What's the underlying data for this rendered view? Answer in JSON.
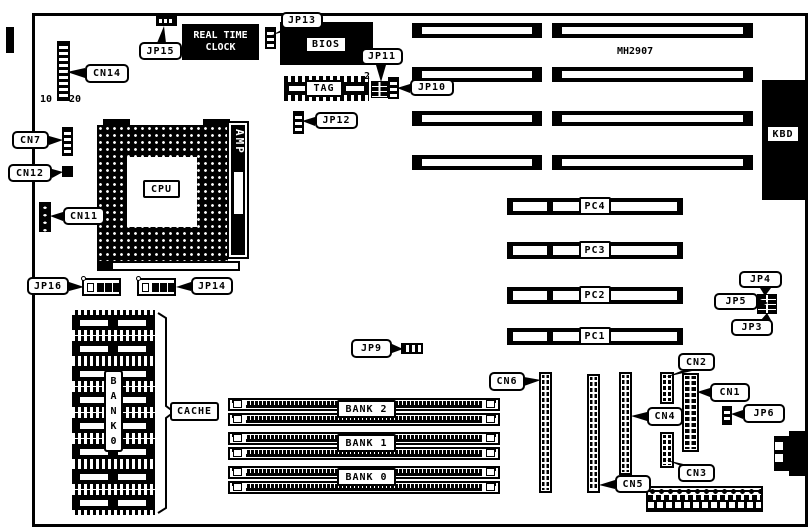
{
  "chips": {
    "rtc": "REAL TIME CLOCK",
    "bios": "BIOS",
    "tag": "TAG",
    "cpu": "CPU",
    "amp": "AMP",
    "kbd": "KBD",
    "chipset": "MH2907",
    "cache": "CACHE",
    "cache_bank": "BANK0"
  },
  "connectors": {
    "cn1": "CN1",
    "cn2": "CN2",
    "cn3": "CN3",
    "cn4": "CN4",
    "cn5": "CN5",
    "cn6": "CN6",
    "cn7": "CN7",
    "cn11": "CN11",
    "cn12": "CN12",
    "cn14": "CN14"
  },
  "jumpers": {
    "jp3": "JP3",
    "jp4": "JP4",
    "jp5": "JP5",
    "jp6": "JP6",
    "jp9": "JP9",
    "jp10": "JP10",
    "jp11": "JP11",
    "jp12": "JP12",
    "jp13": "JP13",
    "jp14": "JP14",
    "jp15": "JP15",
    "jp16": "JP16"
  },
  "slots": {
    "pci": [
      "PC4",
      "PC3",
      "PC2",
      "PC1"
    ],
    "memory_banks": [
      "BANK 2",
      "BANK 1",
      "BANK 0"
    ]
  },
  "pin_markers": {
    "cn14_left": "10",
    "cn14_right": "20",
    "jp11_pin": "2"
  }
}
